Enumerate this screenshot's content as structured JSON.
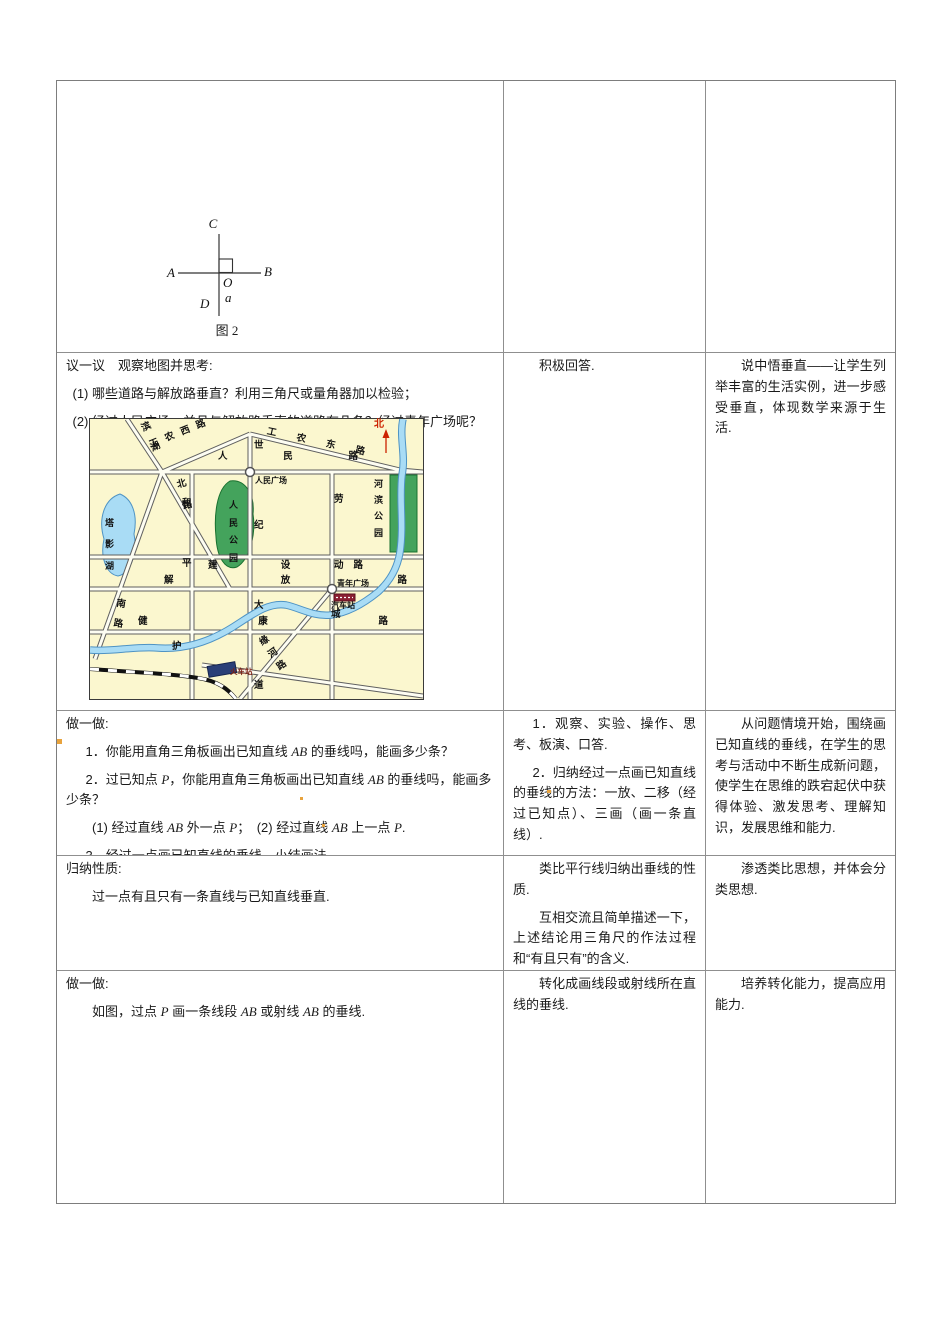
{
  "figure": {
    "labels": {
      "c": "C",
      "a_end": "A",
      "b_end": "B",
      "o": "O",
      "line_a": "a",
      "d": "D"
    },
    "caption": "图 2"
  },
  "row2": {
    "left": {
      "heading": "议一议　观察地图并思考:",
      "item1": "(1) 哪些道路与解放路垂直？利用三角尺或量角器加以检验；",
      "item2": "(2) 经过人民广场，并且与解放路垂直的道路有几条？经过青年广场呢？"
    },
    "middle": {
      "p1": "积极回答."
    },
    "right": {
      "p1": "说中悟垂直——让学生列举丰富的生活实例，进一步感受垂直，体现数学来源于生活."
    }
  },
  "map": {
    "north_label": "北",
    "roads": {
      "renmin": "人民路",
      "jianshe": "建设路",
      "jiefang": "解放路",
      "jiankang": "健康路",
      "shiji_dadao": "世纪大道",
      "laodong": "劳动",
      "heping": "和平",
      "binhu": "滨湖",
      "gongnong_xi": "工农西路",
      "gongnong_dong": "工农东路",
      "bei_lu": "北路",
      "nan_lu": "南路",
      "yuanhe_lu": "缘河路"
    },
    "places": {
      "renmin_guangchang": "人民广场",
      "qingnian_guangchang": "青年广场",
      "renmin_gongyuan": "人民公园",
      "hebin_gongyuan": "河滨公园",
      "taying_hu": "塔影湖",
      "qiche_zhan": "汽车站",
      "huoche_zhan": "火车站",
      "river_hu": "护",
      "river_cheng": "城"
    }
  },
  "row3": {
    "left": {
      "heading": "做一做:",
      "item1": [
        {
          "t": "1．你能用直角三角板画出已知直线 "
        },
        {
          "t": "AB",
          "i": 1
        },
        {
          "t": " 的垂线吗，能画多少条？"
        }
      ],
      "item2": [
        {
          "t": "2．过已知点 "
        },
        {
          "t": "P",
          "i": 1
        },
        {
          "t": "，你能用直角三角板画出已知直线 "
        },
        {
          "t": "AB",
          "i": 1
        },
        {
          "t": " 的垂线吗，能画多少条？"
        }
      ],
      "item2_sub": [
        {
          "t": "(1) 经过直线 "
        },
        {
          "t": "AB",
          "i": 1
        },
        {
          "t": " 外一点 "
        },
        {
          "t": "P",
          "i": 1
        },
        {
          "t": "；　(2) 经过直线 "
        },
        {
          "t": "AB",
          "i": 1
        },
        {
          "t": " 上一点 "
        },
        {
          "t": "P",
          "i": 1
        },
        {
          "t": "."
        }
      ],
      "item3": "3．经过一点画已知直线的垂线，小结画法.",
      "item4": "4．如果身边没有直角三角板，你还能利用其他工具或材料过一点画已知直线的垂线吗？"
    },
    "middle": {
      "p1": "1．观察、实验、操作、思考、板演、口答.",
      "p2": "2．归纳经过一点画已知直线的垂线的方法：一放、二移（经过已知点）、三画（画一条直线）."
    },
    "right": {
      "p1": "从问题情境开始，围绕画已知直线的垂线，在学生的思考与活动中不断生成新问题，使学生在思维的跌宕起伏中获得体验、激发思考、理解知识，发展思维和能力."
    }
  },
  "row4": {
    "left": {
      "heading": "归纳性质:",
      "p1": "过一点有且只有一条直线与已知直线垂直."
    },
    "middle": {
      "p1": "类比平行线归纳出垂线的性质.",
      "p2": "互相交流且简单描述一下，上述结论用三角尺的作法过程和“有且只有”的含义."
    },
    "right": {
      "p1": "渗透类比思想，并体会分类思想."
    }
  },
  "row5": {
    "left": {
      "heading": "做一做:",
      "p1": [
        {
          "t": "如图，过点 "
        },
        {
          "t": "P",
          "i": 1
        },
        {
          "t": " 画一条线段 "
        },
        {
          "t": "AB",
          "i": 1
        },
        {
          "t": " 或射线 "
        },
        {
          "t": "AB",
          "i": 1
        },
        {
          "t": " 的垂线."
        }
      ]
    },
    "middle": {
      "p1": "转化成画线段或射线所在直线的垂线."
    },
    "right": {
      "p1": "培养转化能力，提高应用能力."
    }
  }
}
